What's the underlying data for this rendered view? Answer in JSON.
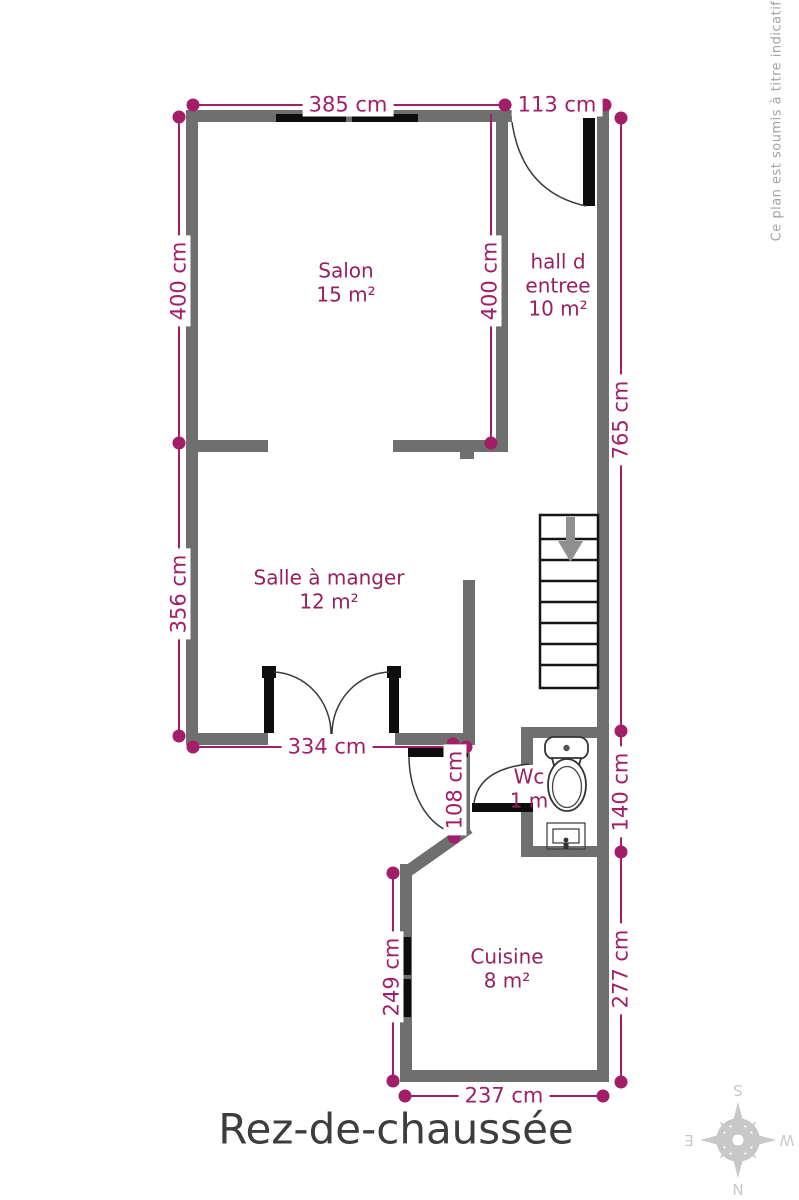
{
  "page": {
    "title": "Rez-de-chaussée",
    "disclaimer": "Ce plan est soumis à titre indicatif"
  },
  "colors": {
    "wall": "#6F6F6F",
    "dimension": "#A21E69",
    "room": "#97205F",
    "title": "#3D3D3D",
    "note": "#A3A3A3",
    "compass": "#C8C8C8",
    "door_window": "#0D0D0D"
  },
  "rooms": {
    "salon": {
      "name": "Salon",
      "area": "15 m²"
    },
    "hall": {
      "name_line1": "hall d",
      "name_line2": "entree",
      "area": "10 m²"
    },
    "salle_a_manger": {
      "name": "Salle à manger",
      "area": "12 m²"
    },
    "wc": {
      "name": "Wc",
      "area": "1 m"
    },
    "cuisine": {
      "name": "Cuisine",
      "area": "8 m²"
    }
  },
  "dimensions": {
    "salon_top_width": "385 cm",
    "hall_top_width": "113 cm",
    "salon_height_left": "400 cm",
    "salon_height_right": "400 cm",
    "right_side_total": "765 cm",
    "salle_height_left": "356 cm",
    "salle_bottom_width": "334 cm",
    "passage_height": "108 cm",
    "wc_height_right": "140 cm",
    "cuisine_height_right": "277 cm",
    "cuisine_height_left": "249 cm",
    "cuisine_bottom_width": "237 cm"
  },
  "compass": {
    "n": "N",
    "e": "E",
    "s": "S",
    "w": "W"
  }
}
